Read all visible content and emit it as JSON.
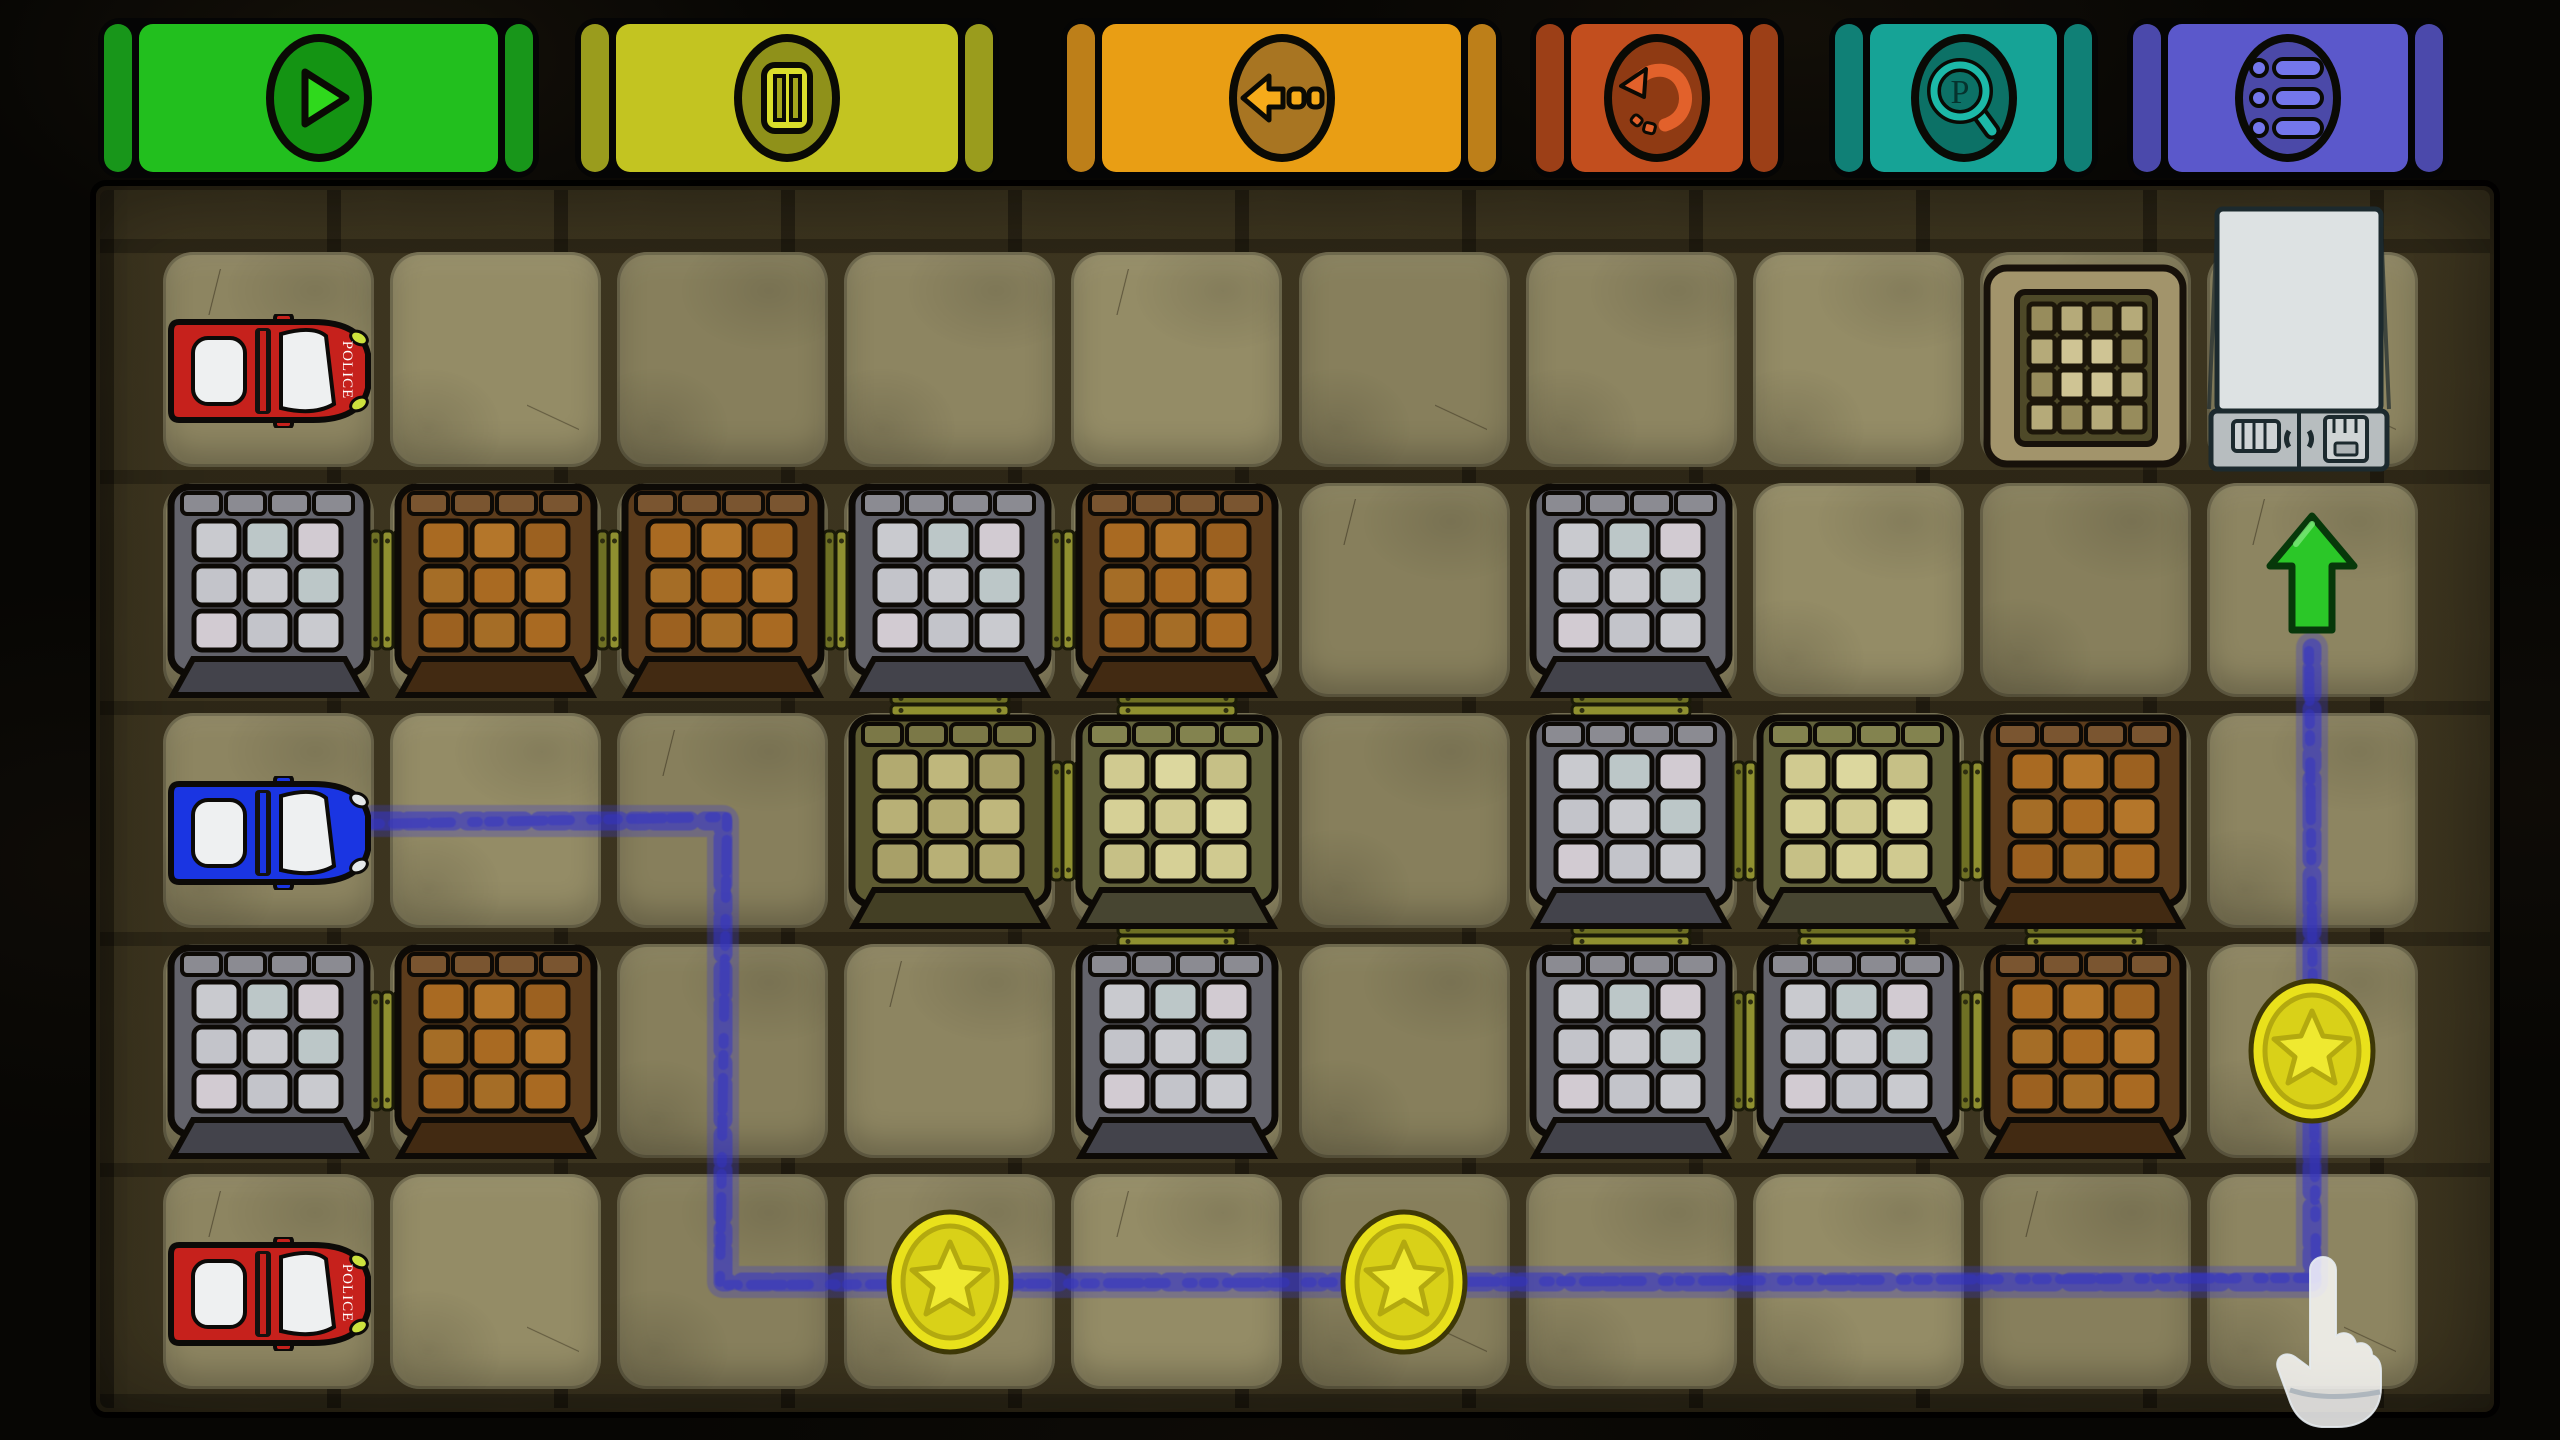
{
  "toolbar": {
    "buttons": [
      {
        "id": "play",
        "icon": "play-icon",
        "color": "#22bf1e",
        "strip_color": "#18961a",
        "circle_color": "#149413",
        "glyph_color": "#2fd91c"
      },
      {
        "id": "pause",
        "icon": "pause-icon",
        "color": "#c3c421",
        "strip_color": "#9a9c1d",
        "circle_color": "#8f911a",
        "glyph_color": "#dade2b"
      },
      {
        "id": "step-back",
        "icon": "back-arrow-icon",
        "color": "#e99e14",
        "strip_color": "#bd7f19",
        "circle_color": "#a87522",
        "glyph_color": "#f6ab1a"
      },
      {
        "id": "restart",
        "icon": "restart-icon",
        "color": "#c24e1e",
        "strip_color": "#9c3f17",
        "circle_color": "#8f3a13",
        "glyph_color": "#e2612b"
      },
      {
        "id": "preview",
        "icon": "magnifier-p-icon",
        "color": "#16a396",
        "strip_color": "#108076",
        "circle_color": "#0c7166",
        "glyph_color": "#1cb9a8",
        "letter": "P"
      },
      {
        "id": "menu",
        "icon": "menu-list-icon",
        "color": "#5b58cb",
        "strip_color": "#4b49ab",
        "circle_color": "#4b49a8",
        "glyph_color": "#7477ec"
      }
    ]
  },
  "board": {
    "rows": 5,
    "cols": 10,
    "palette": {
      "tile": "#8d8561",
      "board_bg": "#342c19",
      "plank": "#8f9030",
      "plank_dark": "#6e7024",
      "plank_nail": "#2e2e10",
      "path": "#3434c6",
      "path_outer": "#3a3ace",
      "coin_gold": "#e9e11b",
      "coin_face": "#d9d118",
      "coin_star": "#efe930",
      "coin_edge": "#3e3806",
      "coin_ring": "#b3a90f",
      "arrow_green": "#2bc728",
      "arrow_edge": "#07380a",
      "car_police": "#c6211c",
      "car_player": "#1a35e2",
      "car_glass": "#eef0f1",
      "headlight_police": "#cde23e",
      "headlight_player": "#e4e8ea",
      "truck_body": "#dde2e3",
      "truck_cab": "#b7bdbf",
      "truck_edge": "#1c2a2e",
      "pit_frame": "#a2946b",
      "pit_wall": "#4e4928",
      "pit_cell": "#b5aa79",
      "pit_cell_bright": "#cfc494",
      "pit_cell_dark": "#978c5c",
      "crates": {
        "grey": {
          "frame": "#63636b",
          "edge": "#8b8b92",
          "cells": [
            "#c9cacf",
            "#bcc7c8",
            "#d2cbd2",
            "#c3c4ca"
          ],
          "skirt": "#43434b"
        },
        "brown": {
          "frame": "#5c3c1c",
          "edge": "#7a5530",
          "cells": [
            "#a96a22",
            "#b4762a",
            "#9c6120",
            "#a56d26"
          ],
          "skirt": "#422a12"
        },
        "olive": {
          "frame": "#5e5b32",
          "edge": "#7b7847",
          "cells": [
            "#b2aa70",
            "#bfb77c",
            "#a8a068",
            "#b8b076"
          ],
          "skirt": "#433f24"
        },
        "olive_light": {
          "frame": "#61613b",
          "edge": "#83834f",
          "cells": [
            "#d0ca90",
            "#dcd79e",
            "#c6c086",
            "#d6d096"
          ],
          "skirt": "#474531"
        }
      }
    },
    "cars": [
      {
        "kind": "police",
        "label": "POLICE",
        "row": 0,
        "col": 0,
        "facing": "right"
      },
      {
        "kind": "player",
        "label": "",
        "row": 2,
        "col": 0,
        "facing": "right"
      },
      {
        "kind": "police",
        "label": "POLICE",
        "row": 4,
        "col": 0,
        "facing": "right"
      }
    ],
    "crates": [
      {
        "row": 1,
        "col": 0,
        "variant": "grey"
      },
      {
        "row": 1,
        "col": 1,
        "variant": "brown"
      },
      {
        "row": 1,
        "col": 2,
        "variant": "brown"
      },
      {
        "row": 1,
        "col": 3,
        "variant": "grey"
      },
      {
        "row": 1,
        "col": 4,
        "variant": "brown"
      },
      {
        "row": 1,
        "col": 6,
        "variant": "grey"
      },
      {
        "row": 2,
        "col": 3,
        "variant": "olive"
      },
      {
        "row": 2,
        "col": 4,
        "variant": "olive_light"
      },
      {
        "row": 2,
        "col": 6,
        "variant": "grey"
      },
      {
        "row": 2,
        "col": 7,
        "variant": "olive_light"
      },
      {
        "row": 2,
        "col": 8,
        "variant": "brown"
      },
      {
        "row": 3,
        "col": 0,
        "variant": "grey"
      },
      {
        "row": 3,
        "col": 1,
        "variant": "brown"
      },
      {
        "row": 3,
        "col": 4,
        "variant": "grey"
      },
      {
        "row": 3,
        "col": 6,
        "variant": "grey"
      },
      {
        "row": 3,
        "col": 7,
        "variant": "grey"
      },
      {
        "row": 3,
        "col": 8,
        "variant": "brown"
      }
    ],
    "links": [
      {
        "row": 1,
        "col": 0,
        "dir": "h"
      },
      {
        "row": 1,
        "col": 1,
        "dir": "h"
      },
      {
        "row": 1,
        "col": 2,
        "dir": "h"
      },
      {
        "row": 1,
        "col": 3,
        "dir": "h"
      },
      {
        "row": 2,
        "col": 3,
        "dir": "h"
      },
      {
        "row": 2,
        "col": 6,
        "dir": "h"
      },
      {
        "row": 2,
        "col": 7,
        "dir": "h"
      },
      {
        "row": 3,
        "col": 0,
        "dir": "h"
      },
      {
        "row": 3,
        "col": 6,
        "dir": "h"
      },
      {
        "row": 3,
        "col": 7,
        "dir": "h"
      },
      {
        "row": 1,
        "col": 3,
        "dir": "v"
      },
      {
        "row": 1,
        "col": 4,
        "dir": "v"
      },
      {
        "row": 1,
        "col": 6,
        "dir": "v"
      },
      {
        "row": 2,
        "col": 4,
        "dir": "v"
      },
      {
        "row": 2,
        "col": 6,
        "dir": "v"
      },
      {
        "row": 2,
        "col": 7,
        "dir": "v"
      },
      {
        "row": 2,
        "col": 8,
        "dir": "v"
      }
    ],
    "coins": [
      {
        "row": 4,
        "col": 3
      },
      {
        "row": 4,
        "col": 5
      },
      {
        "row": 3,
        "col": 9
      }
    ],
    "pit": {
      "row": 0,
      "col": 8
    },
    "truck": {
      "row": 0,
      "col": 9
    },
    "path": {
      "waypoint_cells": [
        [
          2,
          0
        ],
        [
          2,
          2
        ],
        [
          4,
          2
        ],
        [
          4,
          9
        ],
        [
          1,
          9
        ]
      ],
      "start": "player-car",
      "end": "arrow"
    },
    "arrow": {
      "row": 1,
      "col": 9,
      "direction": "up"
    },
    "cursor": {
      "row": 4,
      "col": 9,
      "pointing": "path-corner"
    }
  }
}
